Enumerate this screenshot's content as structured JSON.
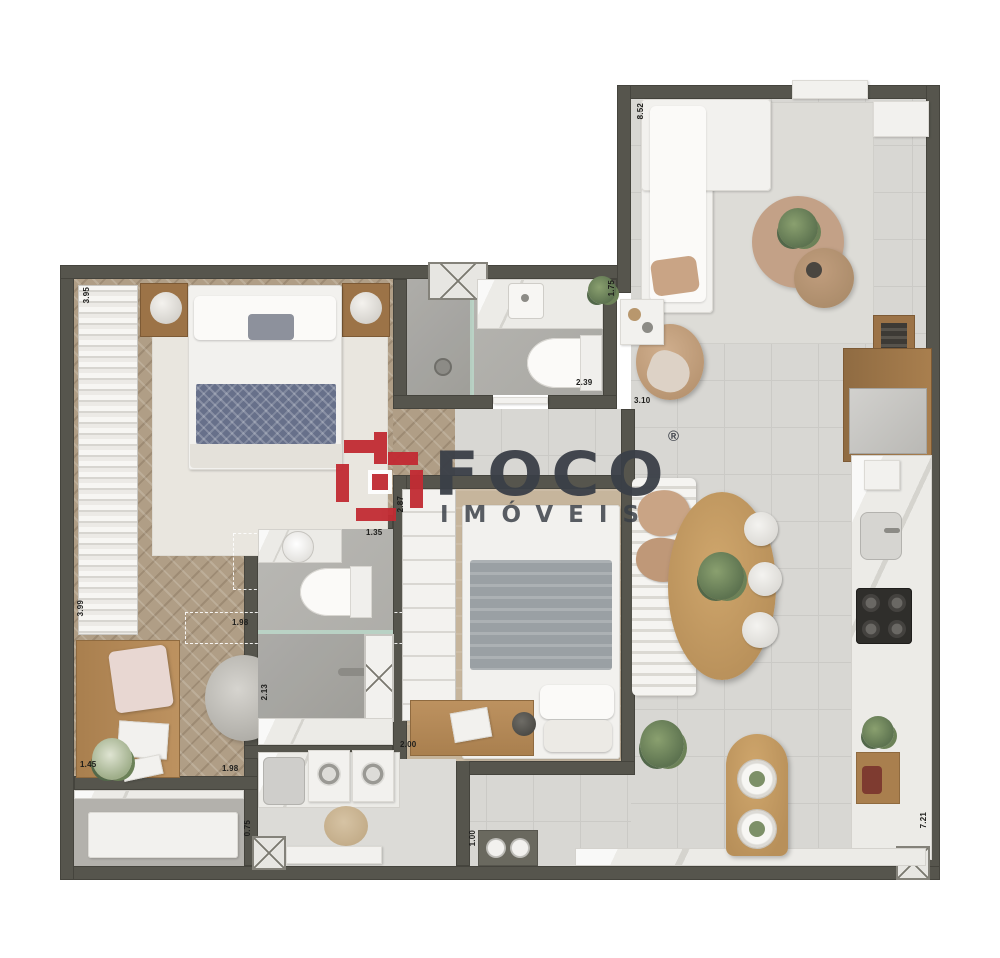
{
  "watermark": {
    "brand": "Foco",
    "registered": "®",
    "subtitle": "IMÓVEIS"
  },
  "dims": [
    "3.95",
    "3.99",
    "1.45",
    "1.98",
    "1.98",
    "2.13",
    "2.00",
    "1.00",
    "2.87",
    "1.35",
    "2.39",
    "3.10",
    "1.75",
    "8.52",
    "7.21",
    "0.75"
  ],
  "colors": {
    "wall": "#56554d",
    "tile_floor": "#d8d7d3",
    "wood_floor": "#b09e86",
    "marble": "#ecebe7",
    "wood_furniture": "#b08a58",
    "accent_red": "#c22b33",
    "logo_text": "#3a3f47",
    "glass": "#bcd9cb",
    "cushion_tan": "#c2a184"
  }
}
